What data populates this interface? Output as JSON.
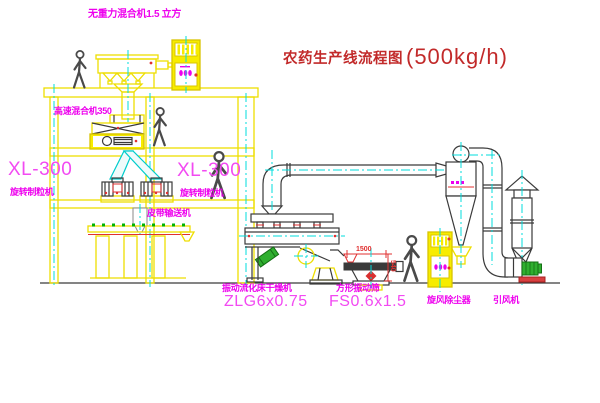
{
  "title": {
    "text": "农药生产线流程图",
    "capacity": "(500kg/h)"
  },
  "labels": {
    "gravity_mixer": "无重力混合机1.5 立方",
    "high_speed_mixer": "高速混合机350",
    "granulator_left_model": "XL-300",
    "granulator_left_name": "旋转制粒机",
    "granulator_right_model": "XL-300",
    "granulator_right_name": "旋转制粒机",
    "belt_conveyor": "皮带输送机",
    "dryer_name": "振动流化床干燥机",
    "dryer_model": "ZLG6x0.75",
    "screen_name": "方形振动筛",
    "screen_model": "FS0.6x1.5",
    "cyclone": "旋风除尘器",
    "fan": "引风机"
  },
  "dimensions": {
    "screen_width": "1500",
    "screen_height": "540"
  },
  "colors": {
    "line_yellow": "#eede00",
    "centerline_cyan": "#00dcdc",
    "label_magenta": "#ee00ee",
    "title_red": "#c22a2a",
    "dim_red": "#e03030",
    "dark_line": "#3a3a3a",
    "motor_green": "#2faf2f"
  }
}
